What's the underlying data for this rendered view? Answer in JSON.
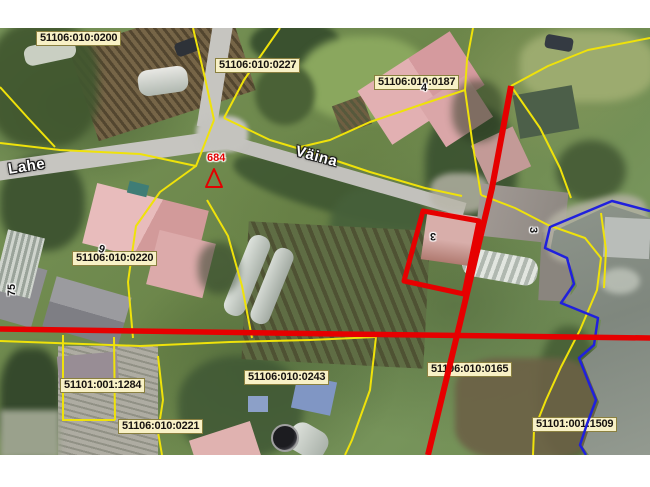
{
  "map": {
    "cadastral_labels": [
      {
        "text": "51106:010:0200",
        "x": 36,
        "y": 3
      },
      {
        "text": "51106:010:0227",
        "x": 215,
        "y": 30
      },
      {
        "text": "51106:010:0187",
        "x": 374,
        "y": 47
      },
      {
        "text": "51106:010:0220",
        "x": 72,
        "y": 223
      },
      {
        "text": "51101:001:1284",
        "x": 60,
        "y": 350
      },
      {
        "text": "51106:010:0221",
        "x": 118,
        "y": 391
      },
      {
        "text": "51106:010:0243",
        "x": 244,
        "y": 342
      },
      {
        "text": "51106:010:0165",
        "x": 427,
        "y": 334
      },
      {
        "text": "51101:001:1509",
        "x": 532,
        "y": 389
      }
    ],
    "street_labels": [
      {
        "text": "Lahe",
        "x": 8,
        "y": 130,
        "rot": -9
      },
      {
        "text": "Väina",
        "x": 295,
        "y": 120,
        "rot": 15
      }
    ],
    "house_numbers": [
      {
        "text": "4",
        "x": 421,
        "y": 54,
        "rot": 0,
        "color": "black"
      },
      {
        "text": "684",
        "x": 207,
        "y": 124,
        "rot": 0,
        "color": "red"
      },
      {
        "text": "3",
        "x": 430,
        "y": 202,
        "rot": 180,
        "color": "black"
      },
      {
        "text": "3",
        "x": 530,
        "y": 196,
        "rot": 90,
        "color": "black"
      },
      {
        "text": "6",
        "x": 99,
        "y": 214,
        "rot": 200,
        "color": "black"
      },
      {
        "text": "75",
        "x": 6,
        "y": 256,
        "rot": -90,
        "color": "black"
      }
    ],
    "survey_marker": {
      "shape": "triangle-outline",
      "points": "214,141 206,159 222,159",
      "color": "#e30000"
    },
    "colors": {
      "parcel_boundary": "#efe20a",
      "highlight_red": "#e60000",
      "water_boundary_blue": "#2020dd",
      "label_background": "#f8f1c6"
    },
    "lines": {
      "yellow": [
        "193,0 205,50 214,92",
        "280,0 244,52 224,90",
        "0,59 28,90 55,119",
        "0,115 60,122 140,126 196,138 214,92",
        "224,90 270,112 310,124 370,144 425,160 462,168",
        "465,62 420,77 370,94 330,112 296,120",
        "473,0 467,32 465,62",
        "465,62 472,112 481,167",
        "511,58 548,38 588,22 650,10",
        "511,58 540,100 560,140 571,170",
        "481,167 515,180 548,197",
        "548,197 585,210 601,230 597,262 580,302 561,339 546,372 534,402 533,427",
        "601,185 606,222 604,260",
        "196,138 160,164 136,198 128,254 133,310",
        "207,172 228,208 242,258 252,310",
        "0,313 140,318 230,314 310,312 376,309",
        "376,309 370,362 352,412 345,427",
        "63,307 63,392",
        "114,309 115,392",
        "62,392 115,392",
        "158,328 163,372 158,404 162,427"
      ],
      "red_horizontal": "0,301 340,306 650,310",
      "red_vertical": "511,58 492,160 460,295 428,427",
      "red_parcel_outline": "423,183 479,193 464,266 404,253",
      "blue_water_boundary": "650,183 612,173 550,199 545,220 567,230 574,256 561,275 598,290 594,317 579,330 589,355 596,372 587,396 580,417 586,427"
    }
  }
}
